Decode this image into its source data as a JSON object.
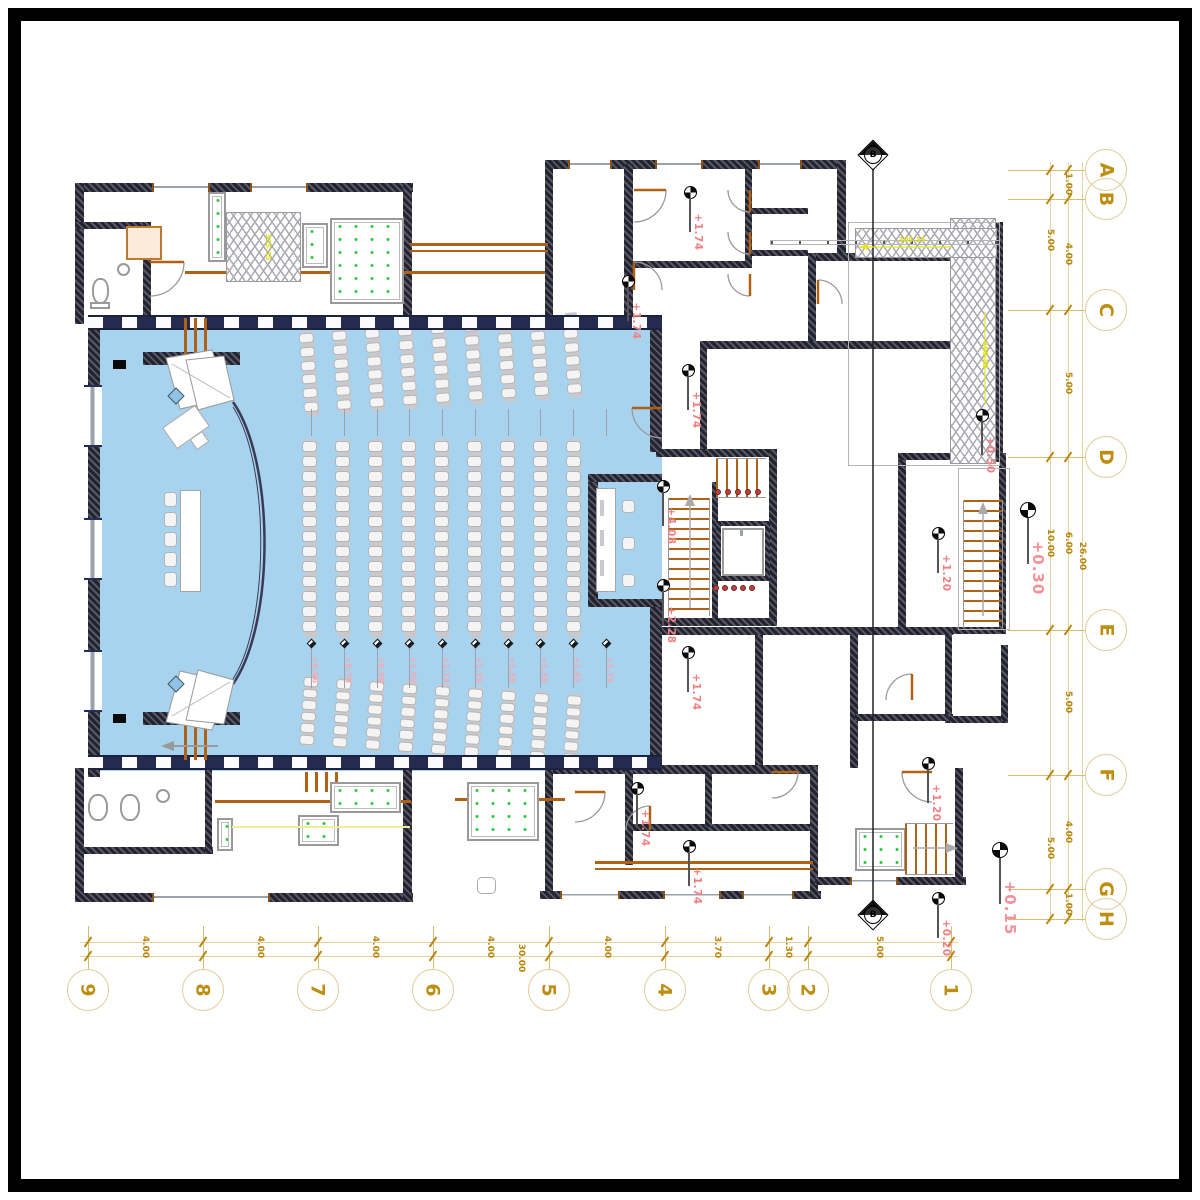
{
  "drawing": {
    "type": "architectural-floor-plan",
    "main_space": "auditorium-with-stage-and-seating"
  },
  "grid": {
    "row_bubbles": [
      "A",
      "B",
      "C",
      "D",
      "E",
      "F",
      "G",
      "H"
    ],
    "col_bubbles": [
      "9",
      "8",
      "7",
      "6",
      "5",
      "4",
      "3",
      "2",
      "1"
    ],
    "row_dims_mid": [
      "1.00",
      "4.00",
      "5.00",
      "6.00",
      "5.00",
      "4.00",
      "1.00"
    ],
    "row_dims_outer": [
      "5.00",
      "10.00",
      "5.00"
    ],
    "row_total": "26.00",
    "col_dims": [
      "4.00",
      "4.00",
      "4.00",
      "4.00",
      "4.00",
      "3.70",
      "1.30",
      "5.00"
    ],
    "col_total": "30.00"
  },
  "annotations": {
    "levels": [
      "+1.74",
      "+1.74",
      "+1.74",
      "+4.08",
      "+2.28",
      "+1.74",
      "+1.74",
      "+1.74",
      "+1.20",
      "+1.20",
      "+0.50",
      "+0.20"
    ],
    "major_levels": [
      "+0.30",
      "+0.15"
    ],
    "aisle_steps": [
      "+0.66",
      "+0.78",
      "+0.90",
      "+1.02",
      "+1.14",
      "+1.26",
      "+1.38",
      "+1.50",
      "+1.62",
      "+1.74"
    ],
    "section_label": "B",
    "ramp_labels": [
      "305.35",
      "305.35",
      "105.35"
    ]
  },
  "colors": {
    "grid_gold": "#BE8E10",
    "dim_gold": "#B8860B",
    "annotation_pink": "#F08080",
    "annotation_yellow": "#E3E312",
    "wall_dark": "#23232e",
    "hall_blue": "#A8D3EE",
    "accent_brown": "#B06114",
    "planter_green": "#2ECC40",
    "seat_gray": "#c9c9cd"
  }
}
